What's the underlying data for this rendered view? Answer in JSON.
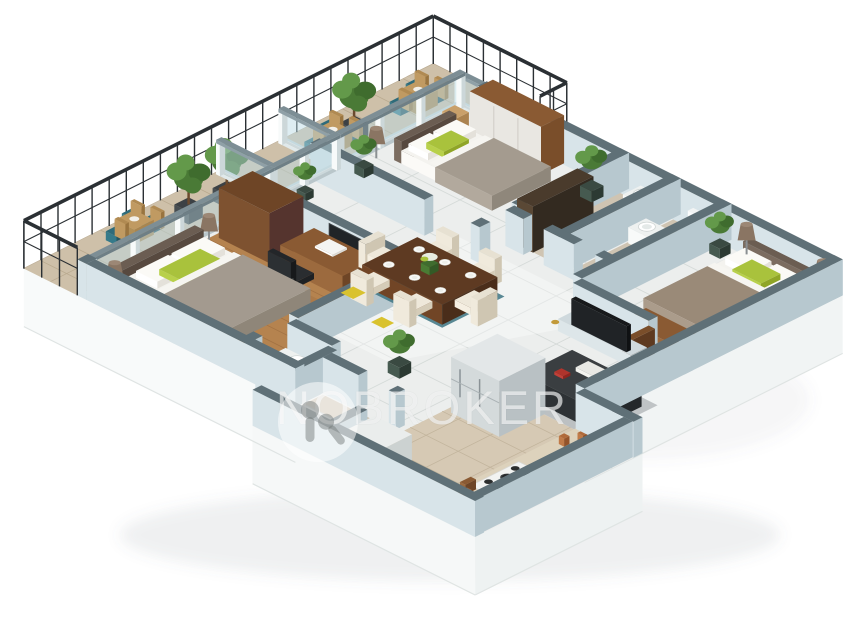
{
  "watermark": {
    "brand": "NOBROKER",
    "logo": "nobroker-keyhole-logo"
  },
  "scene": {
    "type": "3d-isometric-floor-plan-render",
    "description": "3BHK apartment 3D floor plan, top-down isometric view on white background",
    "rooms": [
      {
        "name": "balcony",
        "items": [
          "black-iron-railing",
          "round-wood-table",
          "teal-chairs",
          "potted-trees",
          "glass-partitions"
        ]
      },
      {
        "name": "bedroom-top",
        "items": [
          "double-bed",
          "green-accent-pillow",
          "floor-lamp",
          "wood-wardrobe"
        ]
      },
      {
        "name": "bathroom-top-right",
        "items": [
          "washbasin-pedestal",
          "toilet",
          "dark-storage-cabinet",
          "tall-plant"
        ]
      },
      {
        "name": "bedroom-right",
        "items": [
          "double-bed",
          "green-accent-pillow",
          "cone-lamps",
          "wood-bench",
          "potted-plant",
          "tv-console",
          "flat-tv",
          "open-door"
        ]
      },
      {
        "name": "bedroom-master",
        "items": [
          "double-bed",
          "green-accent-pillow",
          "cone-lamps",
          "walnut-wardrobe",
          "study-desk",
          "office-chair",
          "wall-tv",
          "wood-floor"
        ]
      },
      {
        "name": "living-dining",
        "items": [
          "six-seat-dining-table",
          "white-plates",
          "flower-vase",
          "cream-chairs",
          "teal-rug",
          "yellow-cushions",
          "dark-study-desk",
          "books",
          "laptop",
          "potted-plants"
        ]
      },
      {
        "name": "kitchen",
        "items": [
          "refrigerator",
          "counter",
          "gas-stove",
          "cook-pans",
          "copper-jars",
          "red-pot"
        ]
      },
      {
        "name": "bathroom-2",
        "items": [
          "washbasin-counter",
          "toilet"
        ]
      },
      {
        "name": "utility",
        "items": [
          "shower-tray",
          "washing-machine"
        ]
      }
    ],
    "palette": {
      "bg": "#ffffff",
      "wall_top": "#5f7077",
      "wall_light": "#d8e4e9",
      "wall_mid": "#b7c8cf",
      "wall_dark": "#9fb2ba",
      "glass": "#bcdbe4",
      "frame": "#eef3f4",
      "rail_metal": "#7d8e95",
      "railing": "#2b3034",
      "marble": "#eceeed",
      "marble_line": "#d2d7d5",
      "wood": "#b5834f",
      "wood_line": "#9a6b3f",
      "wood_dark": "#8a5a33",
      "beige": "#cec0a9",
      "beige_line": "#b9a98f",
      "bath_floor": "#cfc4b2",
      "plinth": "#f4f6f6",
      "plinth_edge": "#dfe4e3",
      "brown": "#8a5a33",
      "brown_dark": "#6e4526",
      "walnut": "#5e3a22",
      "white_fab": "#f4f3ef",
      "grey_fab": "#a49b8f",
      "green": "#a9c23c",
      "teal": "#2e6b7a",
      "plant": "#4a7a36",
      "plant_light": "#63994a",
      "dark": "#24272a",
      "steel": "#cdd4d6",
      "red": "#c2372e"
    }
  }
}
